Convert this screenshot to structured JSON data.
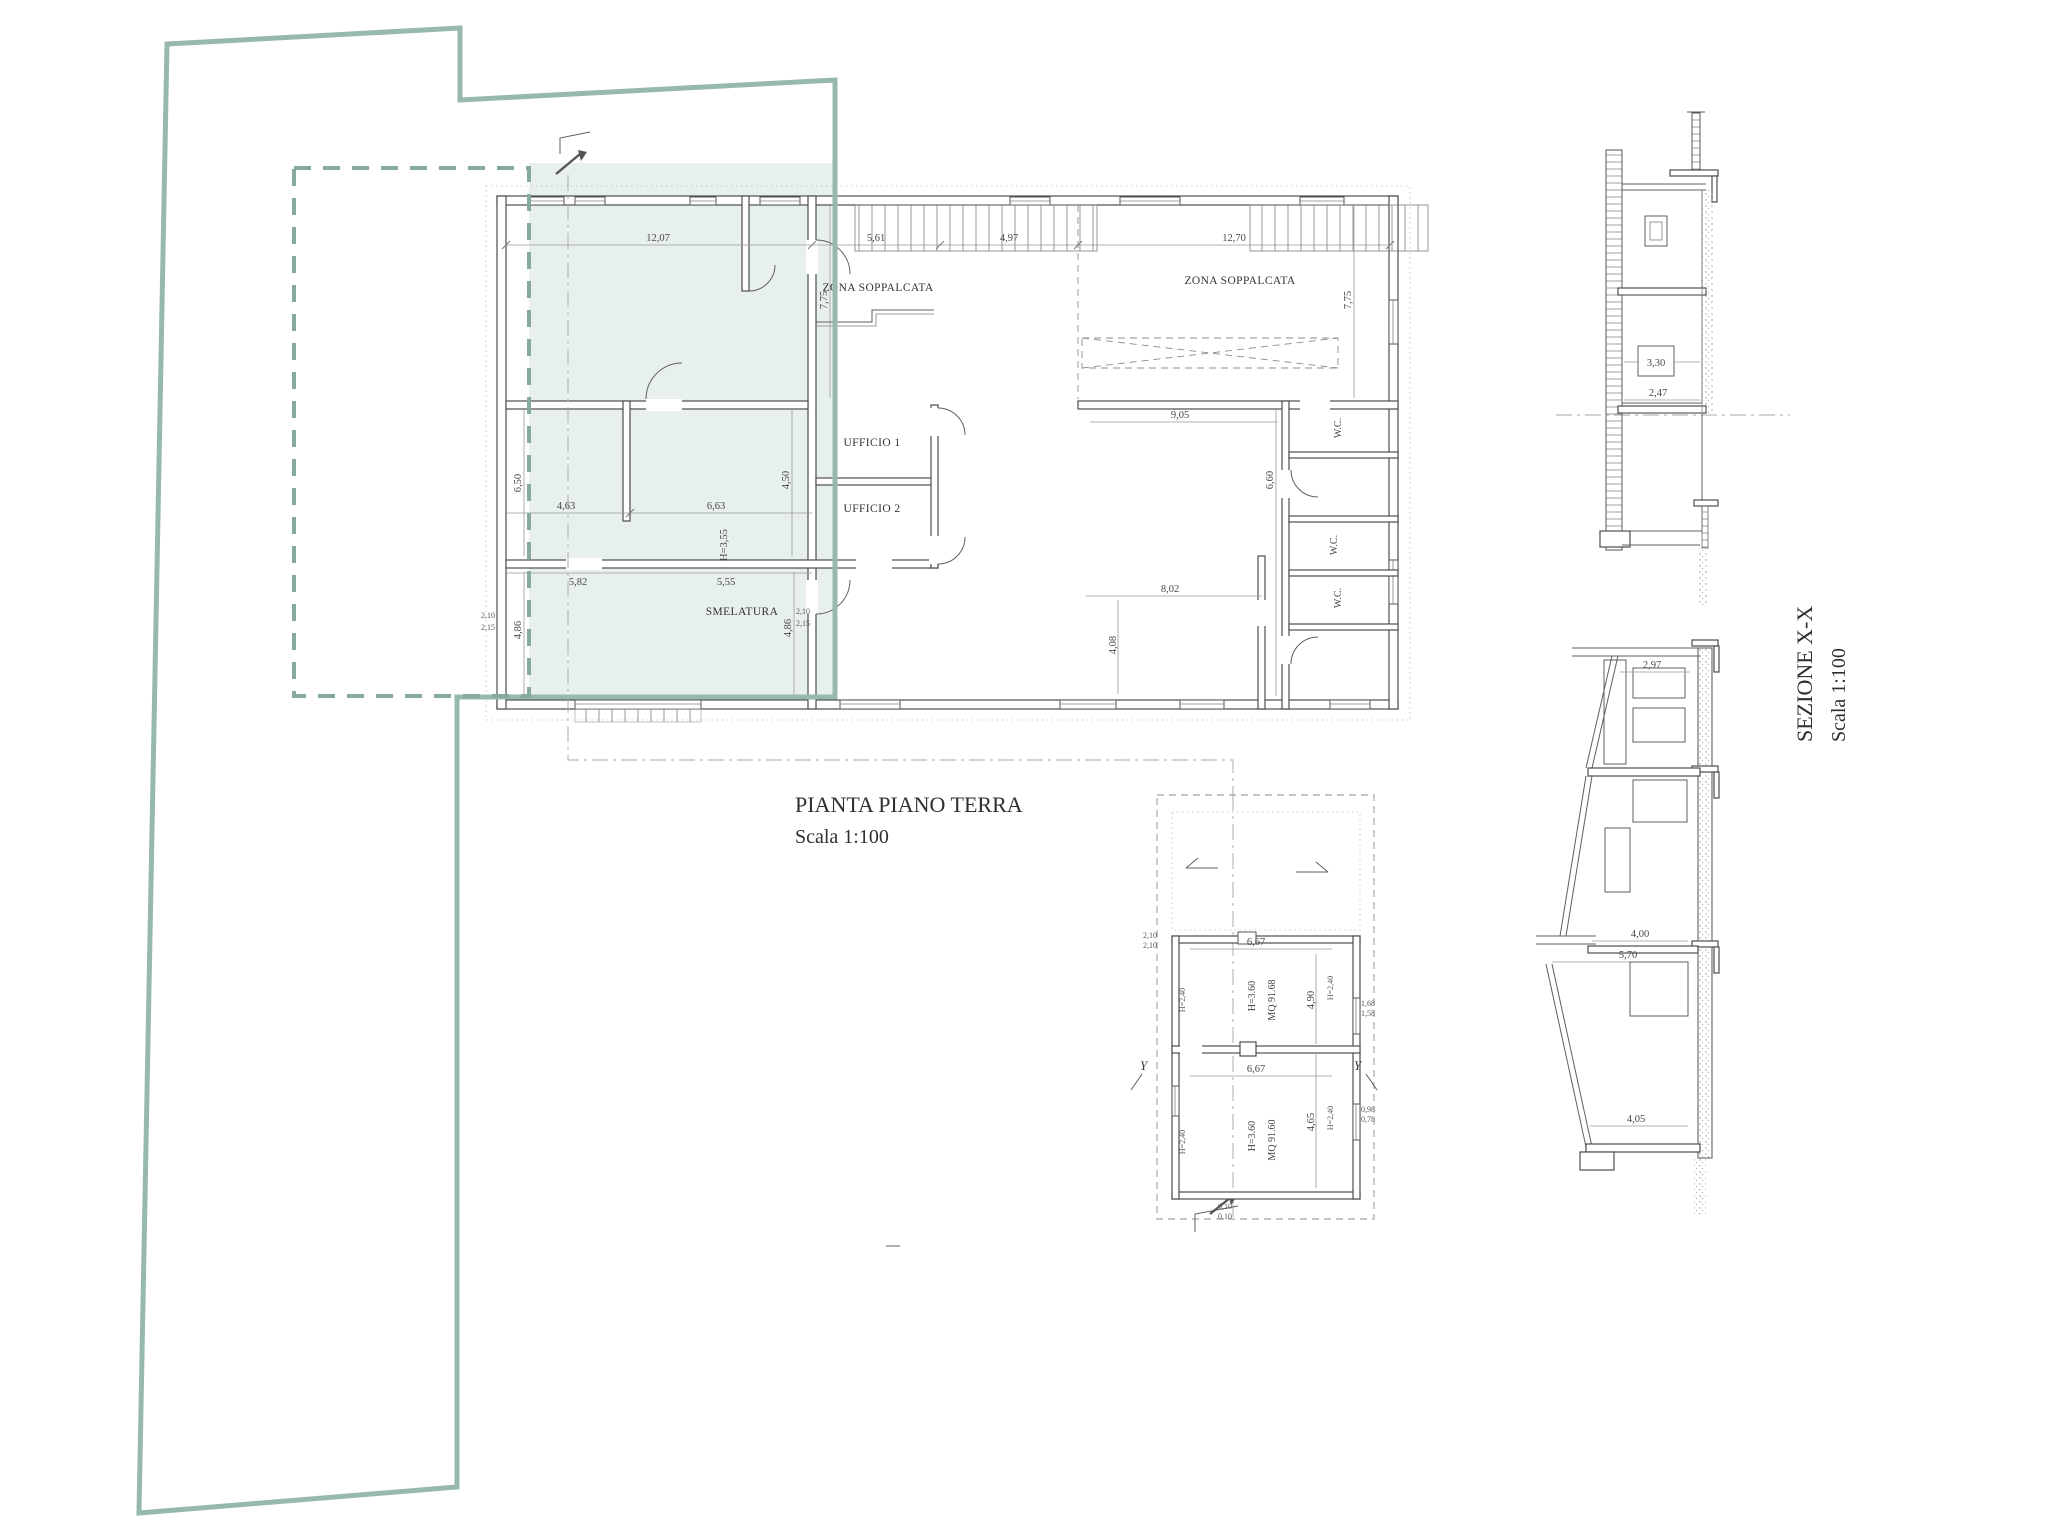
{
  "titles": {
    "plan_title": "PIANTA PIANO TERRA",
    "plan_scale": "Scala 1:100",
    "section_title": "SEZIONE X-X",
    "section_scale": "Scala 1:100"
  },
  "plan": {
    "labels": {
      "zona_left": "ZONA SOPPALCATA",
      "zona_right": "ZONA SOPPALCATA",
      "ufficio1": "UFFICIO 1",
      "ufficio2": "UFFICIO 2",
      "smelatura": "SMELATURA",
      "wc1": "W.C.",
      "wc2": "W.C.",
      "wc3": "W.C."
    },
    "dims": {
      "t1": "12,07",
      "t2": "5,61",
      "t3": "4,97",
      "t4": "12,70",
      "v775a": "7,75",
      "v775b": "7,75",
      "v650": "6,50",
      "v450": "4,50",
      "v486a": "4,86",
      "v486b": "4,86",
      "m463": "4,63",
      "m663": "6,63",
      "m582": "5,82",
      "m555": "5,55",
      "h355": "H=3,55",
      "r905": "9,05",
      "r660": "6,60",
      "r802": "8,02",
      "r408": "4,08",
      "sa": "2,10",
      "sb": "2,15",
      "sc": "2,10",
      "sd": "2,15"
    }
  },
  "small_plan": {
    "rooms": {
      "area1": "MQ 91.68",
      "h1": "H=3.60",
      "area2": "MQ 91.60",
      "h2": "H=3.60"
    },
    "dims": {
      "w1": "6,67",
      "v1": "4,90",
      "w2": "6,67",
      "v2": "4,65",
      "h240": "H=2,40",
      "sa": "2,10",
      "sb": "2,10",
      "sc": "1,68",
      "sd": "1,58",
      "se": "0,98",
      "sf": "0,78",
      "sg": "0,10",
      "sh": "0,10"
    },
    "marker_y": "Y"
  },
  "sections": {
    "dims": {
      "d330": "3,30",
      "d247": "2,47",
      "d297": "2,97",
      "d400": "4,00",
      "d570": "5,70",
      "d405": "4,05"
    }
  },
  "colors": {
    "site_green": "#97b9ab",
    "site_green_dash": "#86ab9b",
    "overlay_fill": "rgba(151,185,171,0.22)",
    "ink": "#3a3a3a"
  }
}
